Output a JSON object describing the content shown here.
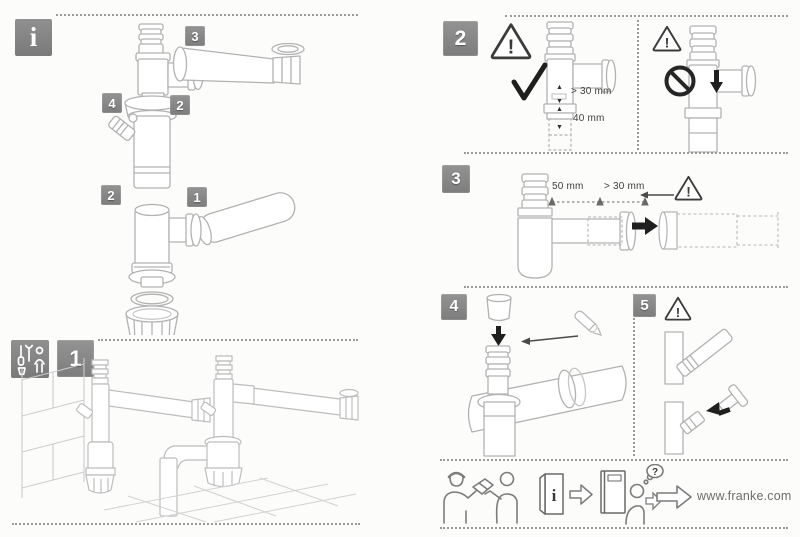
{
  "doc": {
    "brand_url": "www.franke.com"
  },
  "icons": {
    "info": "i",
    "warning": "!",
    "question": "?"
  },
  "glyphs": {
    "arrow_up": "▲",
    "arrow_down": "▼"
  },
  "badges": {
    "step_1": "1",
    "step_2": "2",
    "step_3": "3",
    "step_4": "4",
    "step_5": "5",
    "part_1": "1",
    "part_2_upper": "2",
    "part_2_lower": "2",
    "part_3": "3",
    "part_4": "4"
  },
  "dimensions": {
    "step2_insert_min": "> 30 mm",
    "step2_length": "40 mm",
    "step3_adjust": "50 mm",
    "step3_insert_min": "> 30 mm"
  }
}
